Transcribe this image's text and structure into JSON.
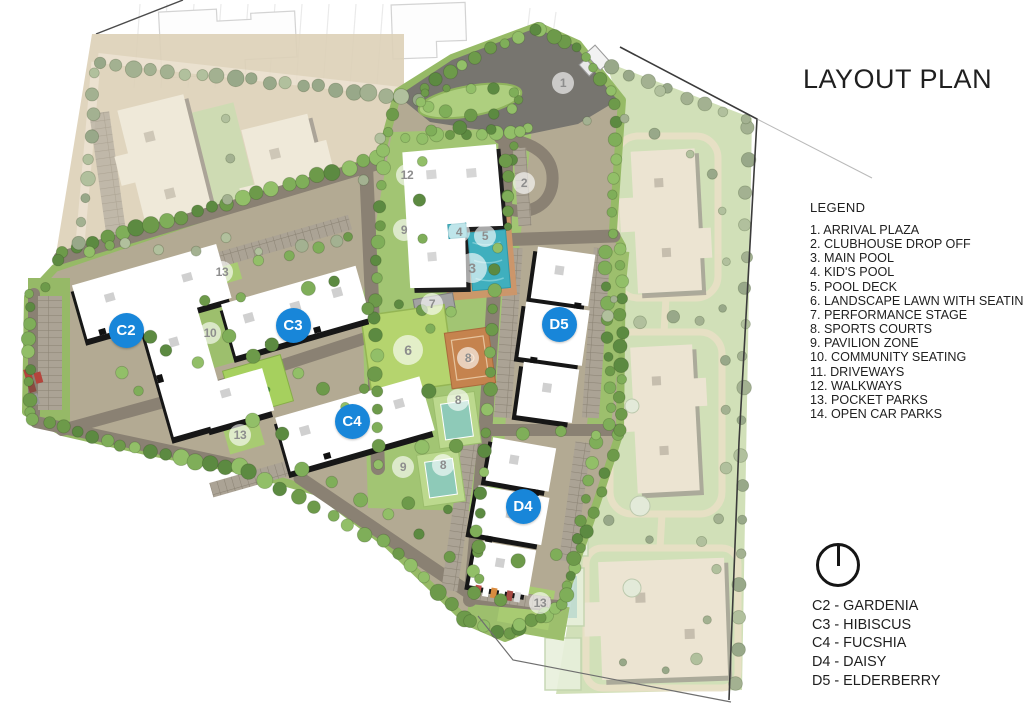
{
  "title": "LAYOUT PLAN",
  "legend": {
    "heading": "LEGEND",
    "items": [
      "1. ARRIVAL PLAZA",
      "2. CLUBHOUSE DROP OFF",
      "3. MAIN POOL",
      "4. KID'S POOL",
      "5. POOL DECK",
      "6. LANDSCAPE LAWN WITH SEATING",
      "7. PERFORMANCE STAGE",
      "8. SPORTS COURTS",
      "9. PAVILION ZONE",
      "10. COMMUNITY SEATING",
      "11. DRIVEWAYS",
      "12. WALKWAYS",
      "13. POCKET PARKS",
      "14. OPEN CAR PARKS"
    ]
  },
  "towers": [
    "C2 - GARDENIA",
    "C3 - HIBISCUS",
    "C4 - FUCSHIA",
    "D4 - DAISY",
    "D5 - ELDERBERRY"
  ],
  "map": {
    "number_markers": [
      "1",
      "12",
      "2",
      "9",
      "4",
      "5",
      "3",
      "7",
      "6",
      "8",
      "8",
      "8",
      "9",
      "13",
      "10",
      "13",
      "13"
    ],
    "building_markers": [
      "C2",
      "C3",
      "C4",
      "D4",
      "D5"
    ]
  },
  "colors": {
    "marker_blue": "#1886d9",
    "marker_number_text": "#8d8d8d",
    "pool_teal": "#3fafbe",
    "lawn_green": "#a2c573",
    "court_orange": "#c5834e",
    "road_grey": "#8a8173",
    "text": "#1f1f1f"
  }
}
